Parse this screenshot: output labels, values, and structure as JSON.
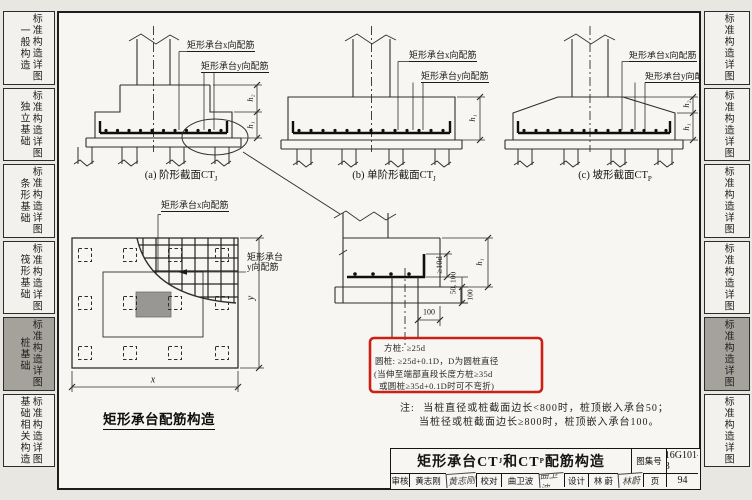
{
  "sidebar_left": {
    "items": [
      {
        "category": "一般构造",
        "label": "标准构造详图",
        "active": false
      },
      {
        "category": "独立基础",
        "label": "标准构造详图",
        "active": false
      },
      {
        "category": "条形基础",
        "label": "标准构造详图",
        "active": false
      },
      {
        "category": "筏形基础",
        "label": "标准构造详图",
        "active": false
      },
      {
        "category": "桩基础",
        "label": "标准构造详图",
        "active": true
      },
      {
        "category": "基础相关构造",
        "label": "标准构造详图",
        "active": false
      }
    ]
  },
  "sidebar_right": {
    "items": [
      {
        "label": "标准构造详图",
        "active": false
      },
      {
        "label": "标准构造详图",
        "active": false
      },
      {
        "label": "标准构造详图",
        "active": false
      },
      {
        "label": "标准构造详图",
        "active": false
      },
      {
        "label": "标准构造详图",
        "active": true
      },
      {
        "label": "标准构造详图",
        "active": false
      }
    ]
  },
  "labels": {
    "rebar_x": "矩形承台x向配筋",
    "rebar_y": "矩形承台y向配筋",
    "rebar_y_line1": "矩形承台",
    "rebar_y_line2": "y向配筋",
    "h1": "h₁",
    "h2": "h₂"
  },
  "captions": {
    "a_main": "(a) 阶形截面CT",
    "a_sub": "J",
    "b_main": "(b) 单阶形截面CT",
    "b_sub": "J",
    "c_main": "(c) 坡形截面CT",
    "c_sub": "P"
  },
  "plan": {
    "title": "矩形承台配筋构造",
    "dim_x": "x",
    "dim_y": "y"
  },
  "detail": {
    "dim_bend": "≥10d",
    "dim_embed": "50, 100",
    "dim_cushion": "100",
    "dim_offset": "100"
  },
  "red_box": {
    "lines": [
      "方桩: ≥25d",
      "圆桩: ≥25d+0.1D，D为圆桩直径",
      "(当伸至端部直段长度方桩≥35d",
      "或圆桩≥35d+0.1D时可不弯折)"
    ]
  },
  "notes": {
    "prefix": "注:",
    "line1": "当桩直径或桩截面边长<800时，桩顶嵌入承台50；",
    "line2": "当桩径或桩截面边长≥800时，桩顶嵌入承台100。"
  },
  "title_block": {
    "title_parts": [
      "矩形承台CT",
      "J",
      "和CT",
      "P",
      "配筋构造"
    ],
    "atlas_label": "图集号",
    "atlas_no": "16G101-3",
    "page_label": "页",
    "page_no": "94",
    "roles": [
      {
        "role": "审核",
        "name": "黄志刚",
        "sig": "黄志刚"
      },
      {
        "role": "校对",
        "name": "曲卫波",
        "sig": "曲卫波"
      },
      {
        "role": "设计",
        "name": "林 蔚",
        "sig": "林蔚"
      }
    ]
  },
  "colors": {
    "highlight_red": "#cb2015",
    "active_tab": "#a5a29c",
    "column_fill": "#989793"
  }
}
